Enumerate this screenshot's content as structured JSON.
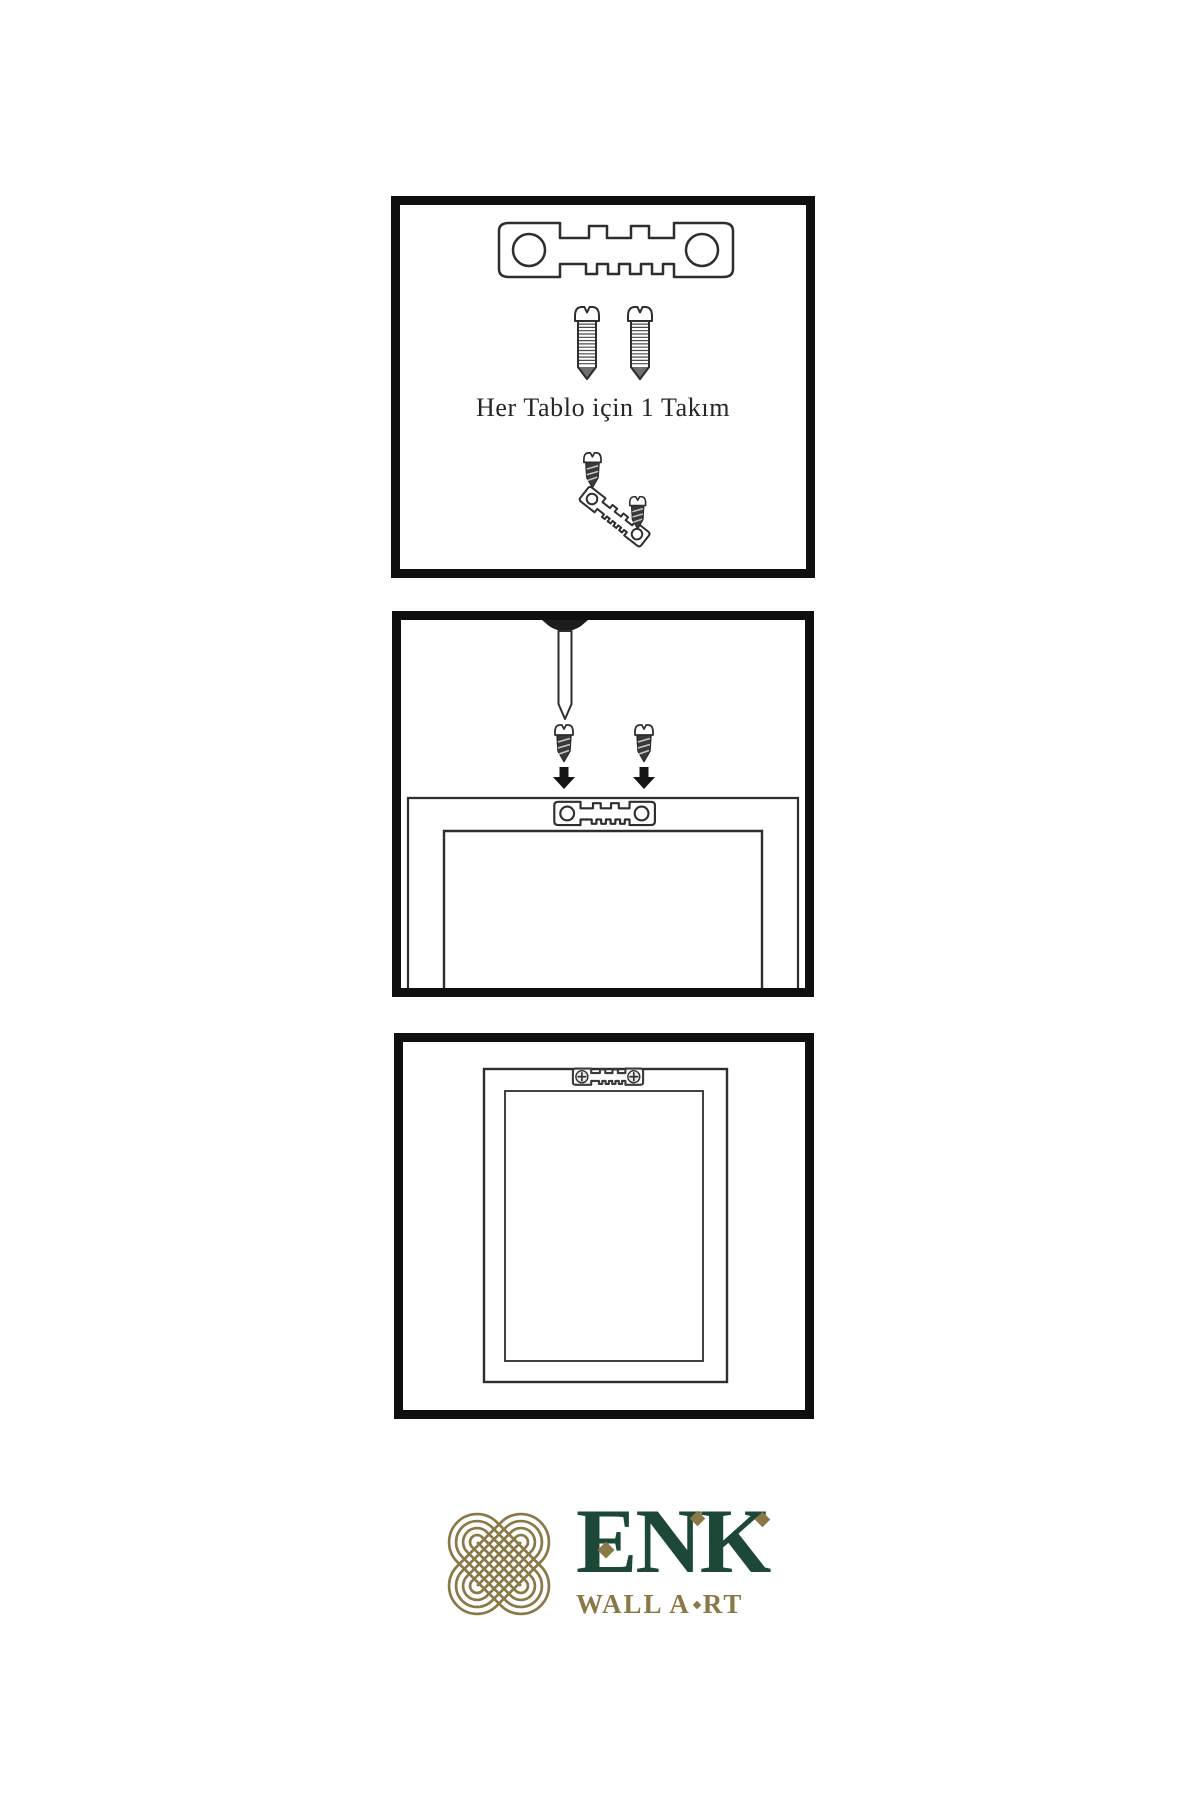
{
  "canvas": {
    "width": 1200,
    "height": 1800,
    "background": "#ffffff"
  },
  "colors": {
    "panel_border": "#0f0f0f",
    "line_art": "#2e2e2e",
    "screw_dark_fill": "#3a3a3a",
    "brand_green": "#1d4737",
    "brand_gold": "#8a7947"
  },
  "panel1": {
    "caption": "Her Tablo için 1 Takım",
    "icons": [
      "sawtooth-hanger-icon",
      "screw-icon",
      "screw-icon",
      "screw-into-hanger-icon"
    ]
  },
  "panel2": {
    "icons": [
      "nail-icon",
      "screw-icon",
      "screw-icon",
      "arrow-down-icon",
      "arrow-down-icon",
      "frame-back-icon",
      "sawtooth-hanger-icon"
    ]
  },
  "panel3": {
    "icons": [
      "picture-frame-icon",
      "mounted-sawtooth-hanger-icon"
    ]
  },
  "brand": {
    "name": "ENK",
    "tagline_full": "WALL ART",
    "tagline_before_diamond": "WALL A",
    "tagline_after_diamond": "RT",
    "logo_icon": "interlaced-knot-icon"
  }
}
